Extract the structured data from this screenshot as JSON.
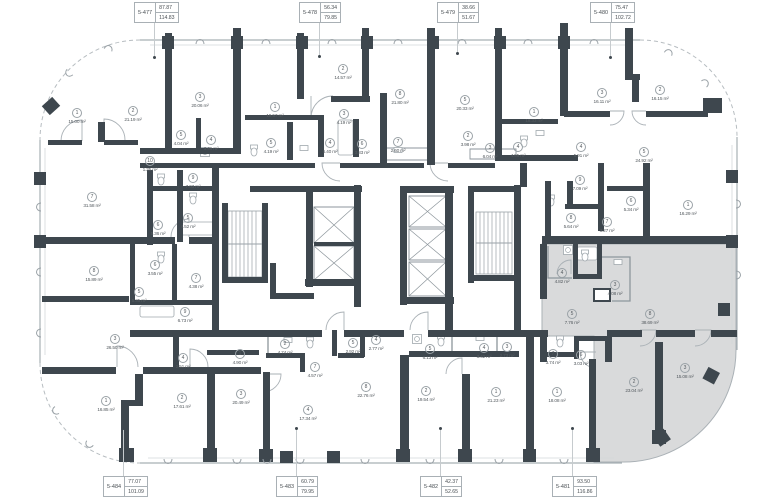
{
  "plan": {
    "area_unit": "m²",
    "colors": {
      "wall": "#3e474e",
      "highlight_fill": "#d9dadb",
      "thin_line": "#a8b0b5",
      "label_text": "#4a5055"
    },
    "units_top": [
      {
        "id": "5-477",
        "area_top": "87.87",
        "area_bottom": "114.83",
        "box_x": 134,
        "box_y": 2,
        "leader_x": 154,
        "dot_y": 57
      },
      {
        "id": "5-478",
        "area_top": "56.34",
        "area_bottom": "79.85",
        "box_x": 299,
        "box_y": 2,
        "leader_x": 319,
        "dot_y": 56
      },
      {
        "id": "5-479",
        "area_top": "38.66",
        "area_bottom": "51.67",
        "box_x": 437,
        "box_y": 2,
        "leader_x": 457,
        "dot_y": 53
      },
      {
        "id": "5-480",
        "area_top": "75.47",
        "area_bottom": "102.72",
        "box_x": 590,
        "box_y": 2,
        "leader_x": 610,
        "dot_y": 57
      }
    ],
    "units_bottom": [
      {
        "id": "5-484",
        "area_top": "77.07",
        "area_bottom": "101.09",
        "box_x": 103,
        "box_y": 476,
        "leader_x": 123,
        "dot_y": 428
      },
      {
        "id": "5-483",
        "area_top": "60.79",
        "area_bottom": "79.95",
        "box_x": 276,
        "box_y": 476,
        "leader_x": 296,
        "dot_y": 428
      },
      {
        "id": "5-482",
        "area_top": "42.37",
        "area_bottom": "52.65",
        "box_x": 420,
        "box_y": 476,
        "leader_x": 440,
        "dot_y": 428
      },
      {
        "id": "5-481",
        "area_top": "93.50",
        "area_bottom": "116.86",
        "box_x": 552,
        "box_y": 476,
        "leader_x": 572,
        "dot_y": 428
      }
    ],
    "rooms": [
      {
        "n": "1",
        "a": "15.00",
        "x": 77,
        "y": 106
      },
      {
        "n": "2",
        "a": "21.19",
        "x": 133,
        "y": 104
      },
      {
        "n": "3",
        "a": "20.06",
        "x": 200,
        "y": 90
      },
      {
        "n": "5",
        "a": "4.04",
        "x": 181,
        "y": 128
      },
      {
        "n": "4",
        "a": "3.46",
        "x": 211,
        "y": 133
      },
      {
        "n": "10",
        "a": "1.35",
        "x": 150,
        "y": 154
      },
      {
        "n": "7",
        "a": "31.58",
        "x": 92,
        "y": 190
      },
      {
        "n": "9",
        "a": "7.03",
        "x": 193,
        "y": 171
      },
      {
        "n": "5",
        "a": "4.52",
        "x": 188,
        "y": 211
      },
      {
        "n": "6",
        "a": "5.36",
        "x": 158,
        "y": 218
      },
      {
        "n": "1",
        "a": "19.57",
        "x": 275,
        "y": 100
      },
      {
        "n": "2",
        "a": "14.57",
        "x": 343,
        "y": 62
      },
      {
        "n": "3",
        "a": "4.19",
        "x": 344,
        "y": 107
      },
      {
        "n": "5",
        "a": "4.19",
        "x": 271,
        "y": 136
      },
      {
        "n": "4",
        "a": "6.40",
        "x": 330,
        "y": 136
      },
      {
        "n": "6",
        "a": "3.83",
        "x": 362,
        "y": 137
      },
      {
        "n": "8",
        "a": "21.80",
        "x": 400,
        "y": 87
      },
      {
        "n": "7",
        "a": "2.60",
        "x": 398,
        "y": 135
      },
      {
        "n": "2",
        "a": "3.98",
        "x": 468,
        "y": 129
      },
      {
        "n": "3",
        "a": "6.04",
        "x": 490,
        "y": 141
      },
      {
        "n": "5",
        "a": "20.33",
        "x": 465,
        "y": 93
      },
      {
        "n": "1",
        "a": "18.33",
        "x": 534,
        "y": 105
      },
      {
        "n": "4",
        "a": "4.95",
        "x": 518,
        "y": 140
      },
      {
        "n": "3",
        "a": "16.11",
        "x": 602,
        "y": 86
      },
      {
        "n": "2",
        "a": "16.15",
        "x": 660,
        "y": 83
      },
      {
        "n": "4",
        "a": "5.91",
        "x": 581,
        "y": 140
      },
      {
        "n": "5",
        "a": "24.92",
        "x": 644,
        "y": 145
      },
      {
        "n": "9",
        "a": "7.09",
        "x": 580,
        "y": 173
      },
      {
        "n": "6",
        "a": "5.34",
        "x": 631,
        "y": 194
      },
      {
        "n": "8",
        "a": "5.64",
        "x": 571,
        "y": 211
      },
      {
        "n": "7",
        "a": "3.27",
        "x": 607,
        "y": 215
      },
      {
        "n": "1",
        "a": "16.29",
        "x": 688,
        "y": 198
      },
      {
        "n": "8",
        "a": "15.89",
        "x": 94,
        "y": 264
      },
      {
        "n": "6",
        "a": "3.55",
        "x": 155,
        "y": 258
      },
      {
        "n": "5",
        "a": "5.35",
        "x": 139,
        "y": 285
      },
      {
        "n": "7",
        "a": "4.38",
        "x": 196,
        "y": 271
      },
      {
        "n": "9",
        "a": "6.73",
        "x": 185,
        "y": 305
      },
      {
        "n": "3",
        "a": "26.50",
        "x": 115,
        "y": 332
      },
      {
        "n": "4",
        "a": "2.51",
        "x": 183,
        "y": 351
      },
      {
        "n": "1",
        "a": "16.85",
        "x": 106,
        "y": 394
      },
      {
        "n": "2",
        "a": "17.61",
        "x": 182,
        "y": 391
      },
      {
        "n": "1",
        "a": "4.90",
        "x": 240,
        "y": 347
      },
      {
        "n": "3",
        "a": "20.49",
        "x": 241,
        "y": 387
      },
      {
        "n": "2",
        "a": "4.74",
        "x": 285,
        "y": 337
      },
      {
        "n": "7",
        "a": "4.57",
        "x": 315,
        "y": 360
      },
      {
        "n": "4",
        "a": "17.34",
        "x": 308,
        "y": 403
      },
      {
        "n": "5",
        "a": "2.92",
        "x": 353,
        "y": 336
      },
      {
        "n": "8",
        "a": "22.76",
        "x": 366,
        "y": 380
      },
      {
        "n": "4",
        "a": "2.77",
        "x": 376,
        "y": 333
      },
      {
        "n": "5",
        "a": "6.13",
        "x": 430,
        "y": 342
      },
      {
        "n": "2",
        "a": "19.54",
        "x": 426,
        "y": 384
      },
      {
        "n": "4",
        "a": "3.42",
        "x": 484,
        "y": 341
      },
      {
        "n": "3",
        "a": "2.73",
        "x": 507,
        "y": 340
      },
      {
        "n": "1",
        "a": "21.23",
        "x": 496,
        "y": 385
      },
      {
        "n": "7",
        "a": "3.74",
        "x": 553,
        "y": 347
      },
      {
        "n": "6",
        "a": "3.03",
        "x": 581,
        "y": 348
      },
      {
        "n": "1",
        "a": "18.08",
        "x": 557,
        "y": 385
      },
      {
        "n": "4",
        "a": "4.82",
        "x": 562,
        "y": 266
      },
      {
        "n": "3",
        "a": "4.08",
        "x": 615,
        "y": 278
      },
      {
        "n": "5",
        "a": "7.76",
        "x": 572,
        "y": 307
      },
      {
        "n": "8",
        "a": "38.69",
        "x": 650,
        "y": 307
      },
      {
        "n": "2",
        "a": "23.04",
        "x": 634,
        "y": 375
      },
      {
        "n": "3",
        "a": "15.08",
        "x": 685,
        "y": 361
      }
    ]
  }
}
